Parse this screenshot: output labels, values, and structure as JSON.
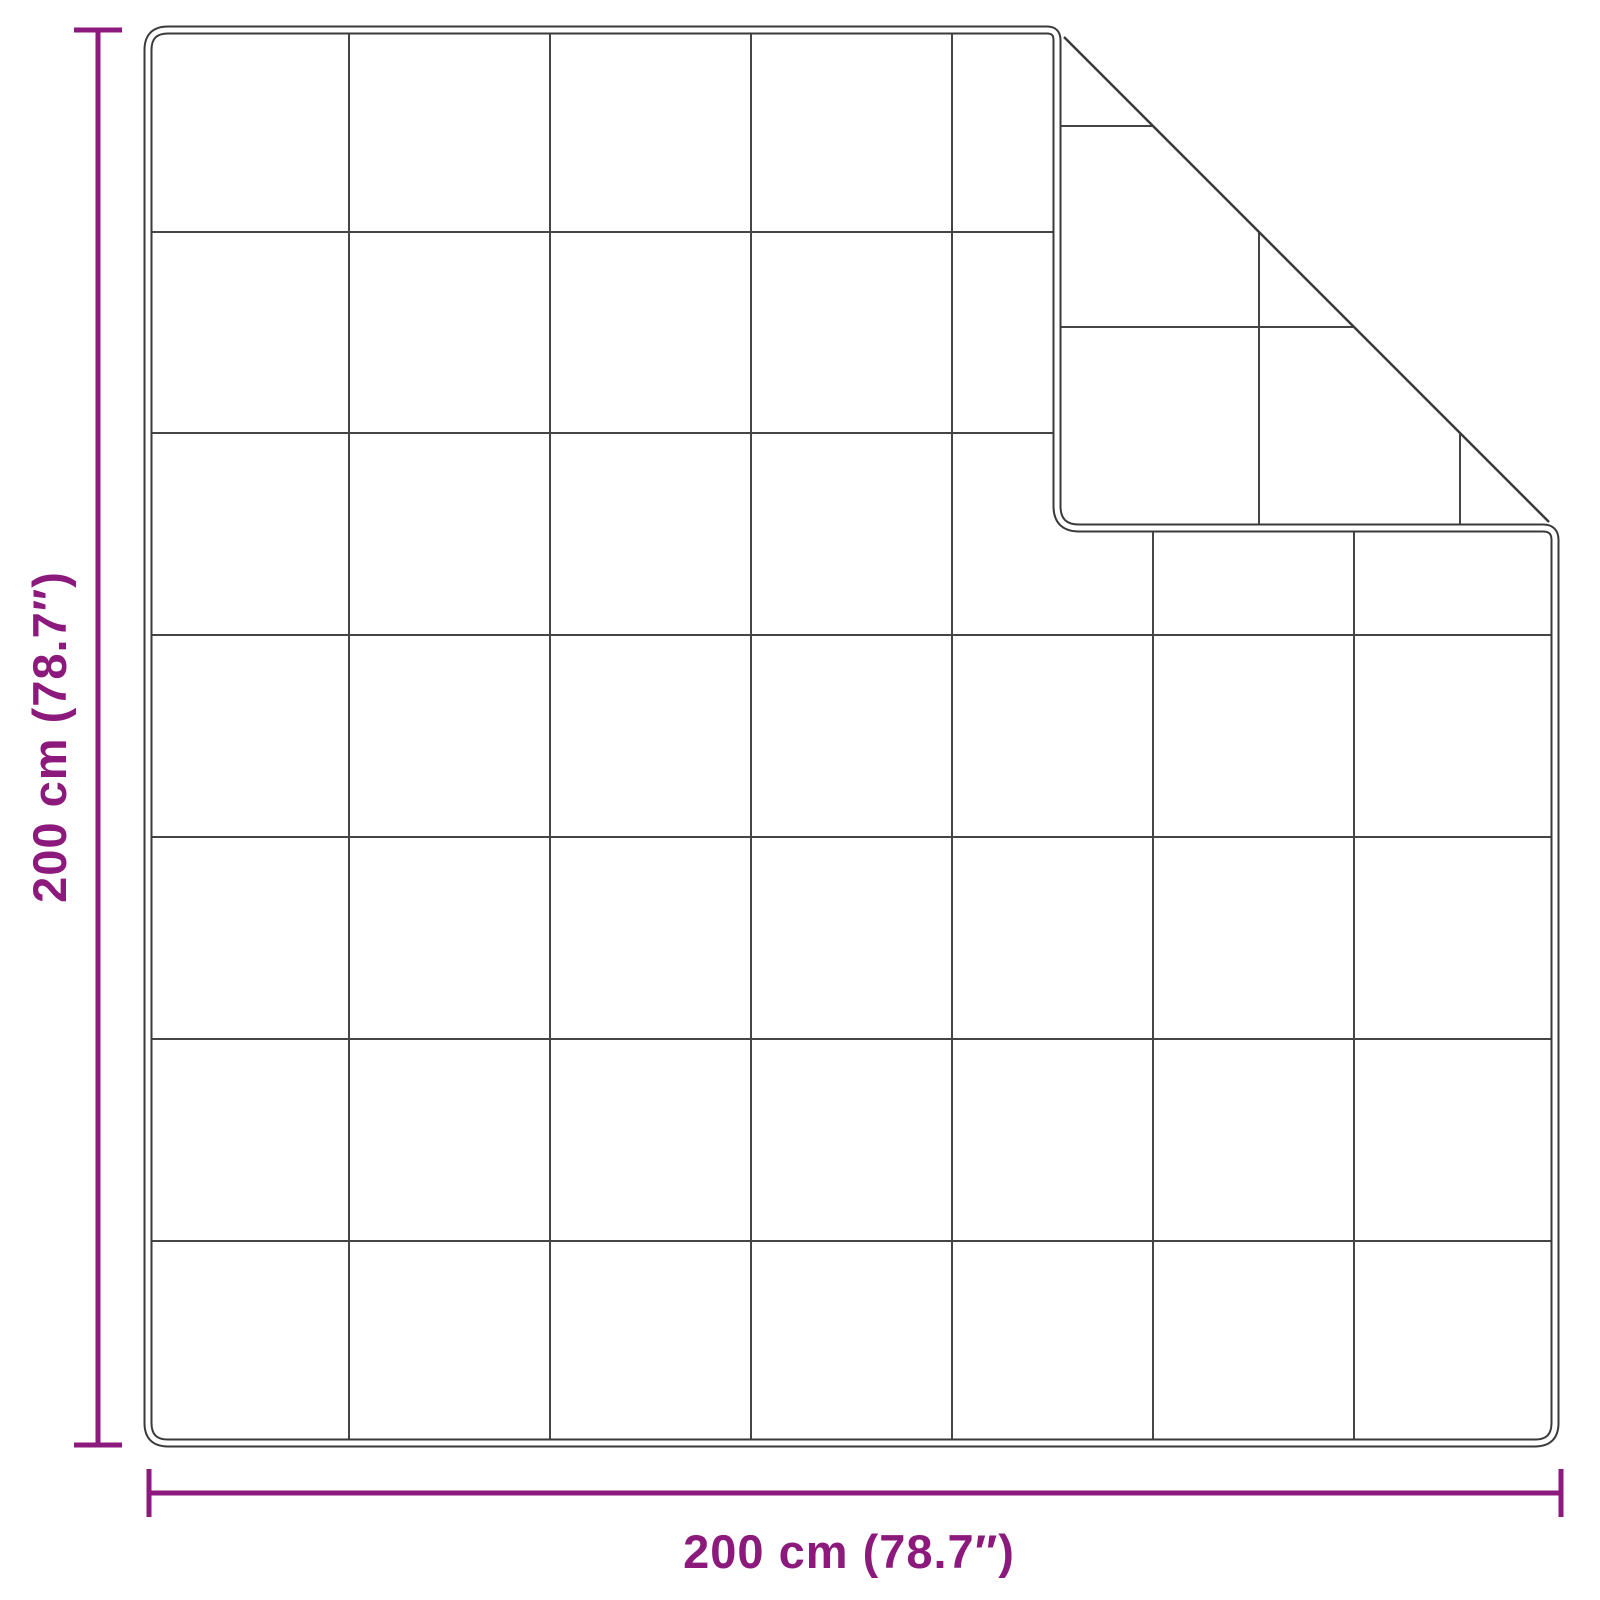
{
  "diagram": {
    "height_label": "200 cm (78.7″)",
    "width_label": "200 cm (78.7″)",
    "grid_rows": 7,
    "grid_cols": 7,
    "colors": {
      "dimension": "#8C1A7C",
      "edge": "#3A3A3A",
      "grid": "#454545",
      "background": "#FFFFFF"
    }
  }
}
